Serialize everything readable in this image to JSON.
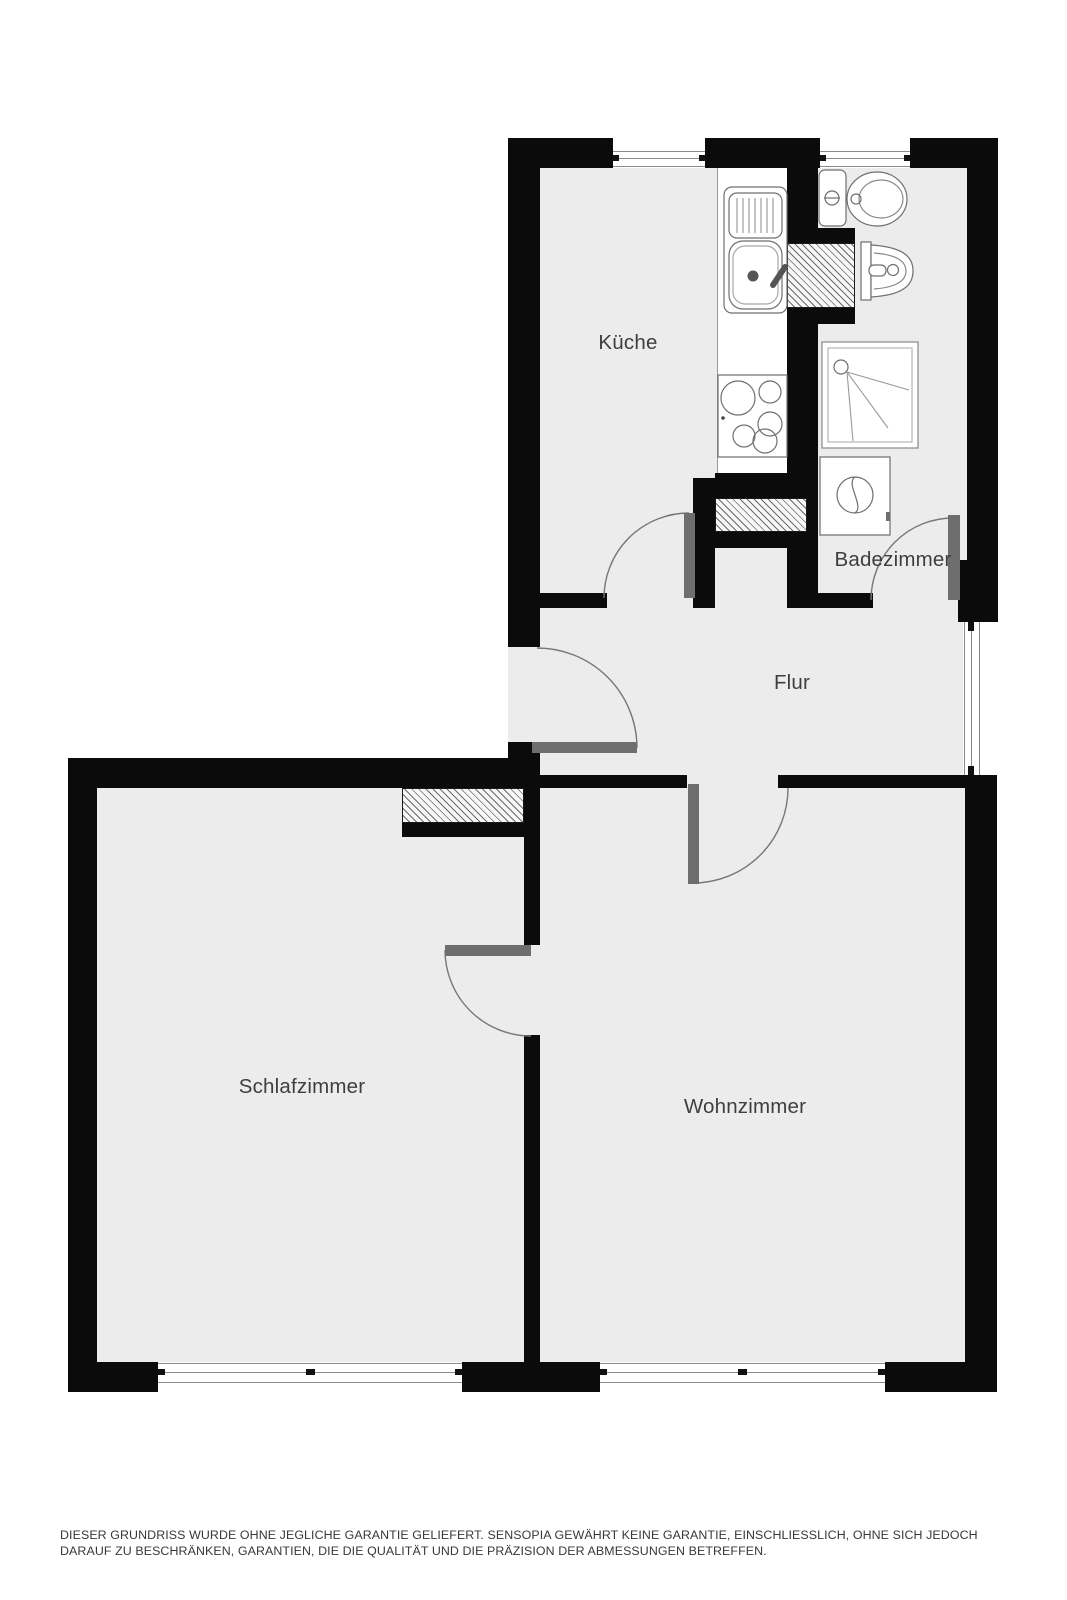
{
  "page": {
    "width": 1067,
    "height": 1600,
    "background": "#ffffff"
  },
  "floorplan": {
    "rooms": [
      {
        "id": "kueche",
        "label": "Küche"
      },
      {
        "id": "badezimmer",
        "label": "Badezimmer"
      },
      {
        "id": "flur",
        "label": "Flur"
      },
      {
        "id": "schlafzimmer",
        "label": "Schlafzimmer"
      },
      {
        "id": "wohnzimmer",
        "label": "Wohnzimmer"
      }
    ],
    "fixtures": [
      "kitchen-sink",
      "kitchen-stove",
      "toilet",
      "washbasin",
      "shower",
      "washing-machine"
    ],
    "doors": [
      "entry-door",
      "kueche-door",
      "badezimmer-door",
      "wohnzimmer-door",
      "schlafzimmer-door"
    ],
    "windows": [
      "kueche-window",
      "badezimmer-window",
      "flur-window",
      "schlafzimmer-window",
      "wohnzimmer-window"
    ],
    "colors": {
      "wall": "#0b0b0b",
      "floor": "#ececec",
      "door_leaf": "#6e6e6e",
      "label_text": "#3e3e3e",
      "fixture_outline": "#777777"
    }
  },
  "disclaimer": {
    "text": "DIESER GRUNDRISS WURDE OHNE JEGLICHE GARANTIE GELIEFERT. SENSOPIA GEWÄHRT KEINE GARANTIE, EINSCHLIESSLICH, OHNE SICH JEDOCH DARAUF ZU BESCHRÄNKEN, GARANTIEN, DIE DIE QUALITÄT UND DIE PRÄZISION DER ABMESSUNGEN BETREFFEN."
  }
}
